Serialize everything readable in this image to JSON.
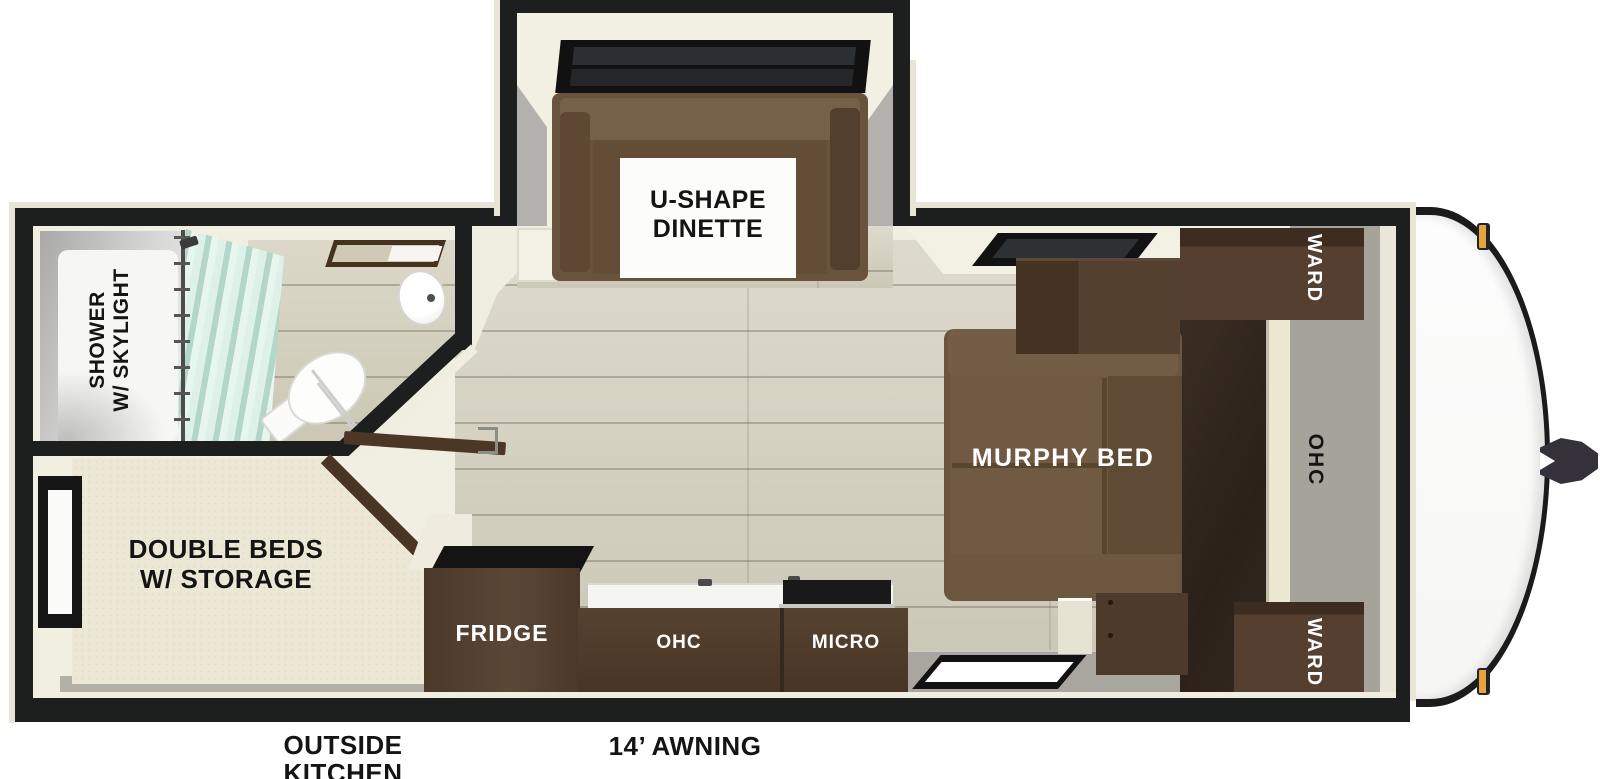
{
  "rooms": {
    "dinette": {
      "line1": "U-SHAPE",
      "line2": "DINETTE"
    },
    "bathroom": {
      "line1": "SHOWER",
      "line2": "W/ SKYLIGHT"
    },
    "bedroom": {
      "line1": "DOUBLE BEDS",
      "line2": "W/ STORAGE"
    },
    "kitchen": {
      "fridge": "FRIDGE",
      "ohc": "OHC",
      "micro": "MICRO"
    },
    "front_bedroom": {
      "murphy": "MURPHY BED",
      "ward_top": "WARD",
      "ward_bottom": "WARD",
      "ohc": "OHC"
    }
  },
  "exterior": {
    "outside_kitchen_line1": "OUTSIDE",
    "outside_kitchen_line2": "KITCHEN",
    "awning": "14’ AWNING"
  },
  "colors": {
    "wall": "#1d1e1e",
    "trim": "#e8e5d7",
    "interior": "#f0ede1",
    "wood_floor": "#d4d0be",
    "gray_floor": "#a9a6a0",
    "sofa_brown": "#6b5540",
    "cabinet_brown": "#543f30",
    "mattress_cream": "#ece8d5",
    "curtain_mint": "#cfe8dd",
    "marker_light": "#e9a33d",
    "black_label": "#141414",
    "white_label": "#ffffff"
  }
}
